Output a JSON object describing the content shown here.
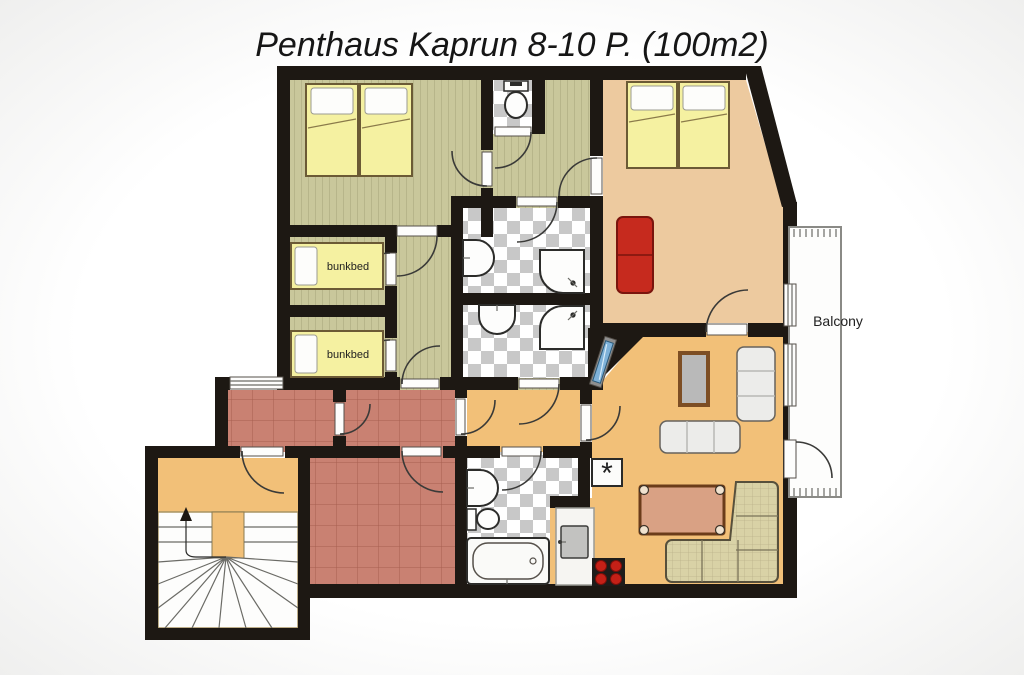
{
  "title": "Penthaus Kaprun 8-10 P. (100m2)",
  "labels": {
    "bunkbed_room_1": "bunkbed",
    "bunkbed_room_2": "bunkbed",
    "balcony": "Balcony",
    "appliance_marker": "*"
  },
  "colors": {
    "wall": "#1d1813",
    "floor_olive": "#c9c79b",
    "floor_tan": "#edca9f",
    "floor_orange": "#f2c078",
    "floor_tile_red": "#c98172",
    "checker_gray": "#c8c8c8",
    "bed_yellow": "#f5f1a1",
    "sofa_red": "#c62a1e",
    "couch_beige": "#d9d2a6",
    "tv_blue": "#7fb2d9",
    "burner_red": "#c42017",
    "background": "#f7f6f4"
  }
}
